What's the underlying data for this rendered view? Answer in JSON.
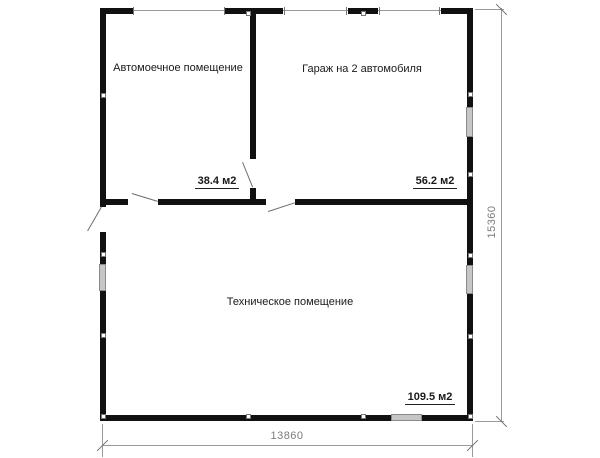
{
  "rooms": [
    {
      "name": "Автомоечное помещение",
      "area": "38.4 м2"
    },
    {
      "name": "Гараж на 2 автомобиля",
      "area": "56.2 м2"
    },
    {
      "name": "Техническое помещение",
      "area": "109.5 м2"
    }
  ],
  "dimensions": {
    "bottom": "13860",
    "right": "15360"
  },
  "colors": {
    "wall": "#111111",
    "thin_line": "#9a9a9a",
    "dimension_text": "#7b7b7b",
    "window_fill": "#c6c6c6",
    "window_border": "#8a8a8a",
    "label_text": "#1a1a1a",
    "background": "#ffffff"
  }
}
